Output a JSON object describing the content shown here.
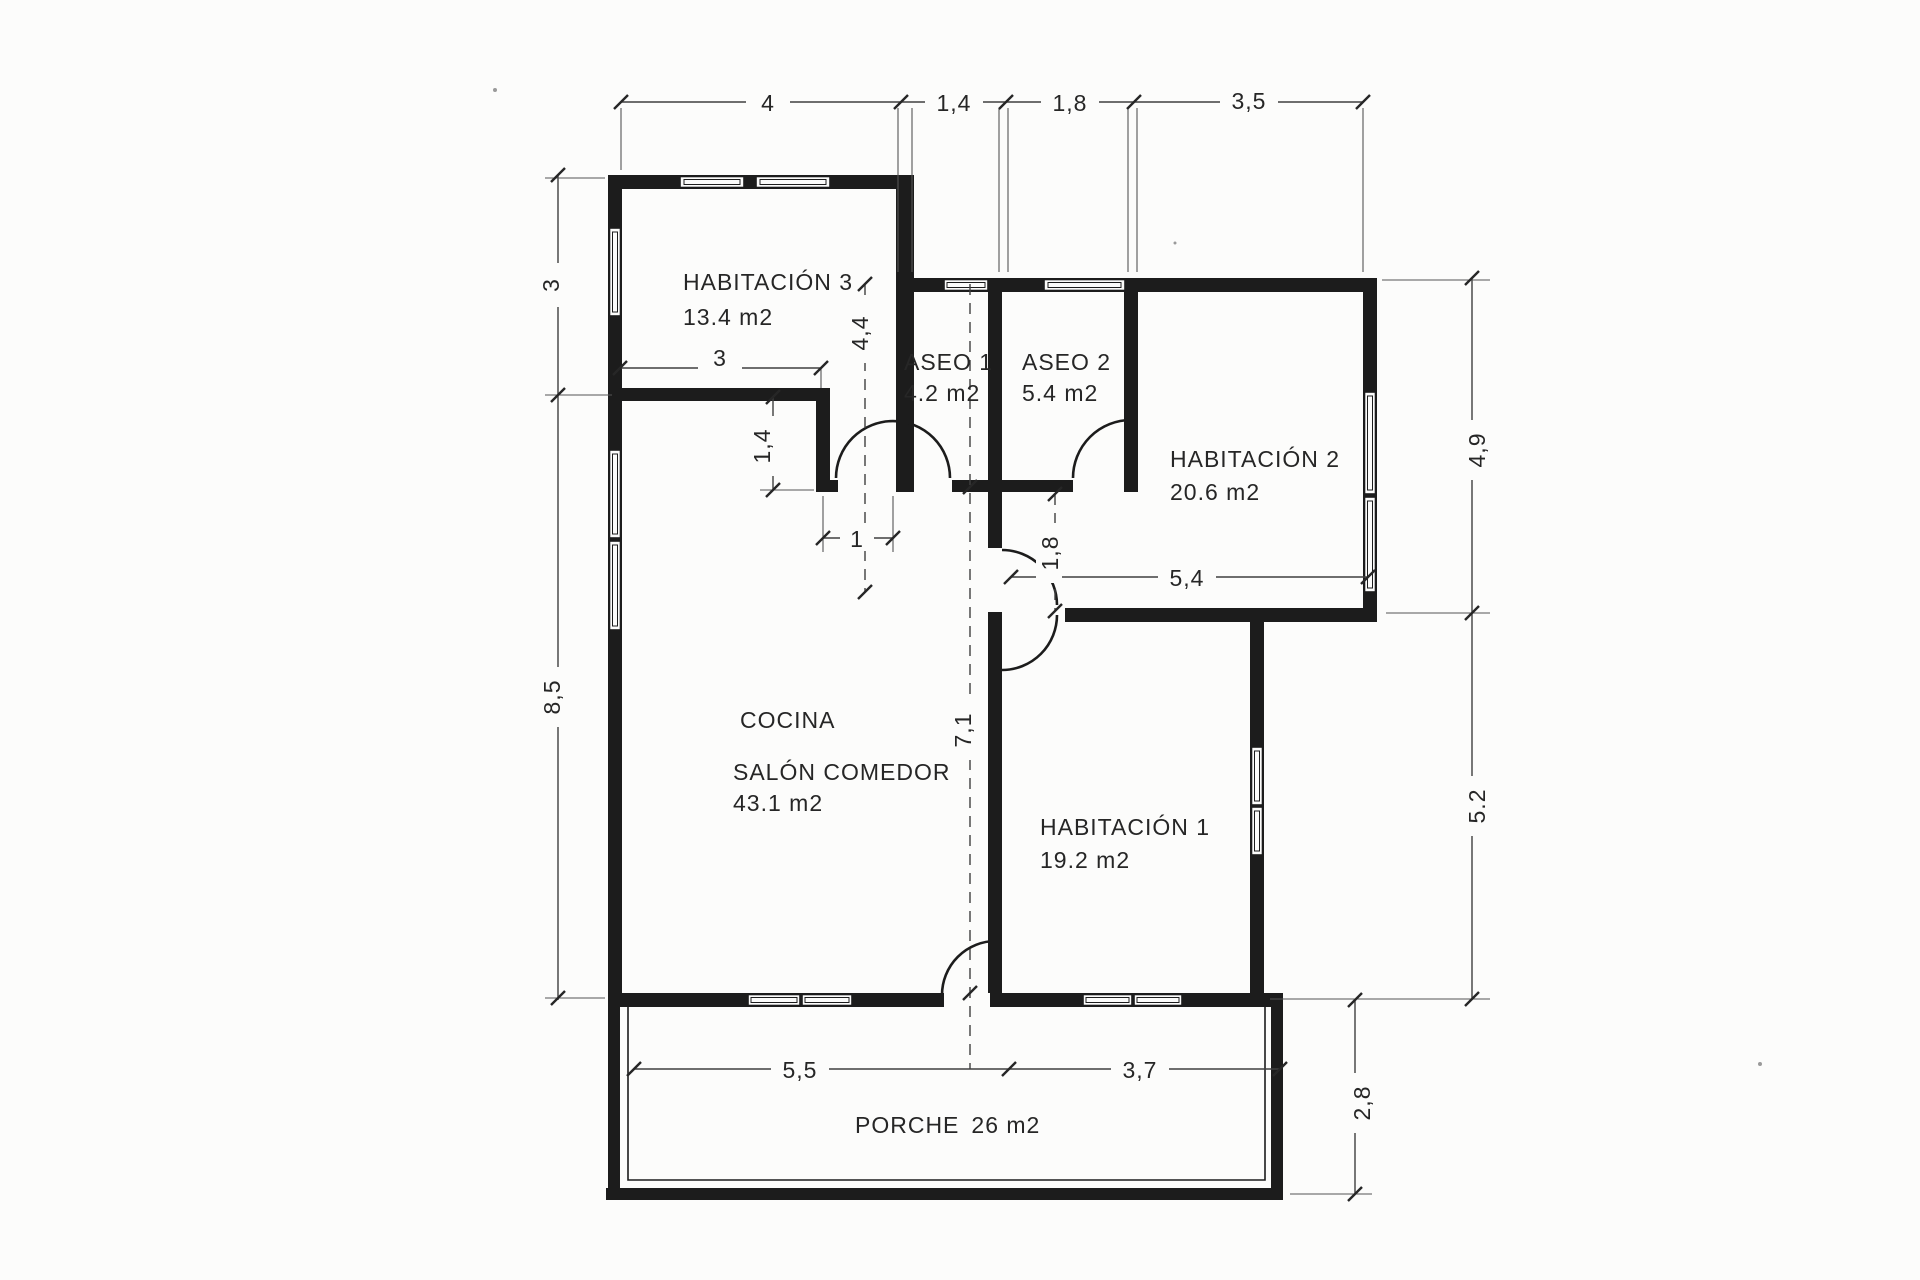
{
  "drawing_title": "floor-plan",
  "rooms": {
    "habitacion3": {
      "name": "HABITACIÓN 3",
      "area": "13.4 m2"
    },
    "aseo1": {
      "name": "ASEO 1",
      "area": "4.2 m2"
    },
    "aseo2": {
      "name": "ASEO 2",
      "area": "5.4 m2"
    },
    "habitacion2": {
      "name": "HABITACIÓN 2",
      "area": "20.6 m2"
    },
    "cocina": {
      "name": "COCINA"
    },
    "salon": {
      "name": "SALÓN COMEDOR",
      "area": "43.1 m2"
    },
    "habitacion1": {
      "name": "HABITACIÓN 1",
      "area": "19.2 m2"
    },
    "porche": {
      "name": "PORCHE",
      "area": "26 m2"
    }
  },
  "dimensions": {
    "top": {
      "d1": "4",
      "d2": "1,4",
      "d3": "1,8",
      "d4": "3,5"
    },
    "left": {
      "upper": "3",
      "lower": "8,5"
    },
    "right": {
      "upper": "4,9",
      "lower": "5.2"
    },
    "bottom": {
      "left": "5,5",
      "right": "3,7",
      "porch_depth": "2,8"
    },
    "interior": {
      "hab3_width": "3",
      "jog_height": "1,4",
      "door_width": "1",
      "hall_height": "4,4",
      "strip_height": "1,8",
      "strip_width": "5,4",
      "salon_height": "7,1"
    }
  },
  "colors": {
    "ink": "#1c1c1c",
    "paper": "#fcfcfb"
  }
}
